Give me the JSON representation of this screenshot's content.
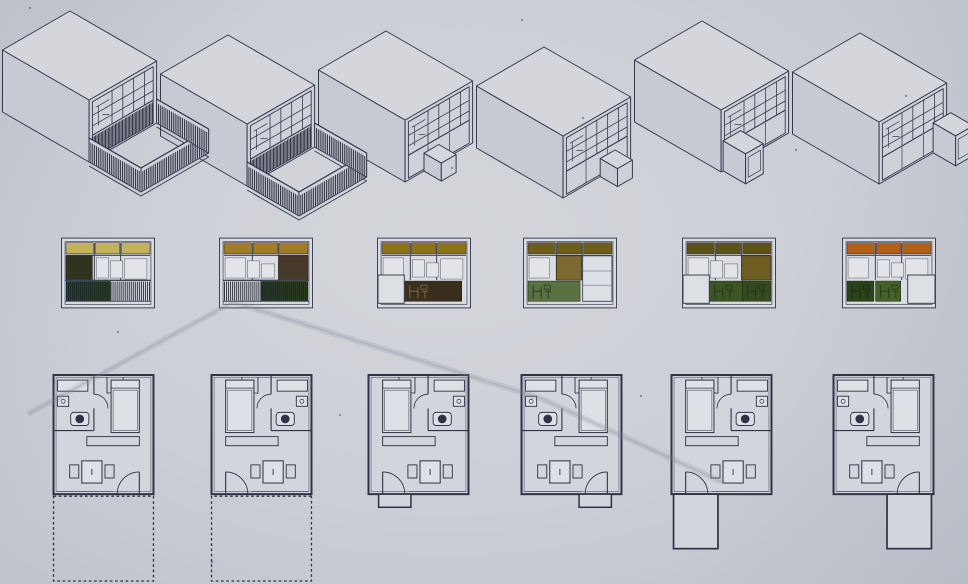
{
  "board": {
    "kind": "architectural-study-board",
    "rows": [
      {
        "id": "axonometric-row",
        "representation": "axonometric"
      },
      {
        "id": "elevations-row",
        "representation": "front-elevation"
      },
      {
        "id": "floor-plans-row",
        "representation": "floor-plan"
      }
    ],
    "palette": {
      "paper": "#cbced5",
      "ink": "#343a50",
      "hatch": "#222737",
      "top_face": "#d4d6dc",
      "left_wall": "#c7cad2",
      "facade": "#ced1d8",
      "panel_white": "#e2e4e8",
      "elevation_bg": "#dadce1",
      "plan_fill": "#d2d5db",
      "artifact": "#7f8796",
      "dust": "#3a3f50"
    },
    "units": [
      {
        "name": "unit-1",
        "axon": {
          "variant": "terrace",
          "porch": null
        },
        "elevation": {
          "top_color": "#c3b257",
          "accent": {
            "color": "#32331e",
            "pos": "left"
          },
          "bottom": {
            "type": "railing",
            "green": "#2c4720",
            "green_side": "left"
          },
          "white_box": null
        },
        "plan": {
          "bath_side": "left",
          "door_side": "right",
          "extension": "terrace-dashed"
        }
      },
      {
        "name": "unit-2",
        "axon": {
          "variant": "terrace",
          "porch": null
        },
        "elevation": {
          "top_color": "#a27c26",
          "accent": {
            "color": "#47392a",
            "pos": "right"
          },
          "bottom": {
            "type": "railing",
            "green": "#2a421e",
            "green_side": "right"
          },
          "white_box": null
        },
        "plan": {
          "bath_side": "right",
          "door_side": "left",
          "extension": "terrace-dashed"
        }
      },
      {
        "name": "unit-3",
        "axon": {
          "variant": "stoop",
          "porch": "left"
        },
        "elevation": {
          "top_color": "#8d7418",
          "accent": null,
          "bottom": {
            "type": "panels",
            "panels": [
              {
                "x": 0.27,
                "w": 0.68,
                "color": "#3a2e1d",
                "stroke": "#7a6845"
              }
            ]
          },
          "white_box": "left"
        },
        "plan": {
          "bath_side": "right",
          "door_side": "left",
          "extension": "stoop"
        }
      },
      {
        "name": "unit-4",
        "axon": {
          "variant": "stoop",
          "porch": "right"
        },
        "elevation": {
          "top_color": "#6f5f16",
          "accent": {
            "color": "#7b6930",
            "pos": "center"
          },
          "bottom": {
            "type": "panels",
            "panels": [
              {
                "x": 0,
                "w": 0.62,
                "color": "#5a7142",
                "stroke": "#2b3a1e"
              }
            ]
          },
          "white_box": "right-column"
        },
        "plan": {
          "bath_side": "left",
          "door_side": "right",
          "extension": "stoop"
        }
      },
      {
        "name": "unit-5",
        "axon": {
          "variant": "box",
          "porch": "left"
        },
        "elevation": {
          "top_color": "#5d5313",
          "accent": {
            "color": "#6e5d20",
            "pos": "right"
          },
          "bottom": {
            "type": "panels",
            "panels": [
              {
                "x": 0.27,
                "w": 0.4,
                "color": "#3d5524",
                "stroke": "#243616"
              },
              {
                "x": 0.66,
                "w": 0.34,
                "color": "#35491f",
                "stroke": "#243616"
              }
            ]
          },
          "white_box": "left"
        },
        "plan": {
          "bath_side": "right",
          "door_side": "left",
          "extension": "porch"
        }
      },
      {
        "name": "unit-6",
        "axon": {
          "variant": "box",
          "porch": "right"
        },
        "elevation": {
          "top_color": "#b26018",
          "accent": null,
          "bottom": {
            "type": "panels",
            "panels": [
              {
                "x": 0,
                "w": 0.32,
                "color": "#2b431b",
                "stroke": "#1c2c10"
              },
              {
                "x": 0.34,
                "w": 0.3,
                "color": "#456127",
                "stroke": "#263c14"
              }
            ]
          },
          "white_box": "right"
        },
        "plan": {
          "bath_side": "left",
          "door_side": "right",
          "extension": "porch"
        }
      }
    ],
    "photo_artifacts": {
      "wire_shadow_path": "M 28 414 L 233 302 L 540 398 L 722 482",
      "dust_specks": [
        [
          30,
          8
        ],
        [
          583,
          118
        ],
        [
          796,
          150
        ],
        [
          118,
          332
        ],
        [
          906,
          96
        ],
        [
          641,
          396
        ],
        [
          212,
          562
        ],
        [
          522,
          20
        ],
        [
          340,
          415
        ],
        [
          452,
          168
        ]
      ]
    }
  }
}
